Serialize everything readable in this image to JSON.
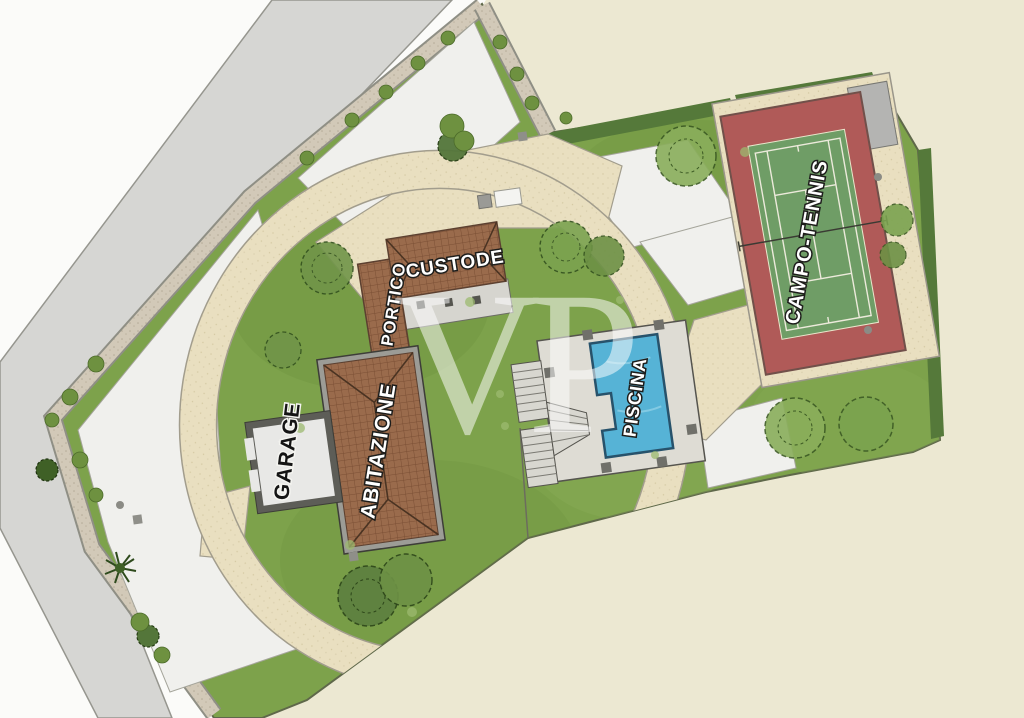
{
  "plan": {
    "watermark": "VP",
    "labels": {
      "garage": "GARAGE",
      "abitazione": "ABITAZIONE",
      "portico": "PORTICO",
      "custode": "CUSTODE",
      "piscina": "PISCINA",
      "campo_tennis": "CAMPO-TENNIS"
    },
    "colors": {
      "paper_cream": "#ece8d2",
      "outside_white": "#fbfbf9",
      "road_grey": "#d6d6d3",
      "pavement_white": "#f0f0ed",
      "gravel_strip": "#d2c9b8",
      "driveway_beige": "#e9dfc0",
      "lawn_green": "#7da24b",
      "hedge_green": "#55793a",
      "roof_brown": "#9a6b4c",
      "pool_blue": "#56b3d6",
      "pool_deck_grey": "#dedcd4",
      "tennis_red": "#b05a58",
      "tennis_green": "#6f9d66",
      "shed_grey": "#b4b4b2"
    }
  }
}
